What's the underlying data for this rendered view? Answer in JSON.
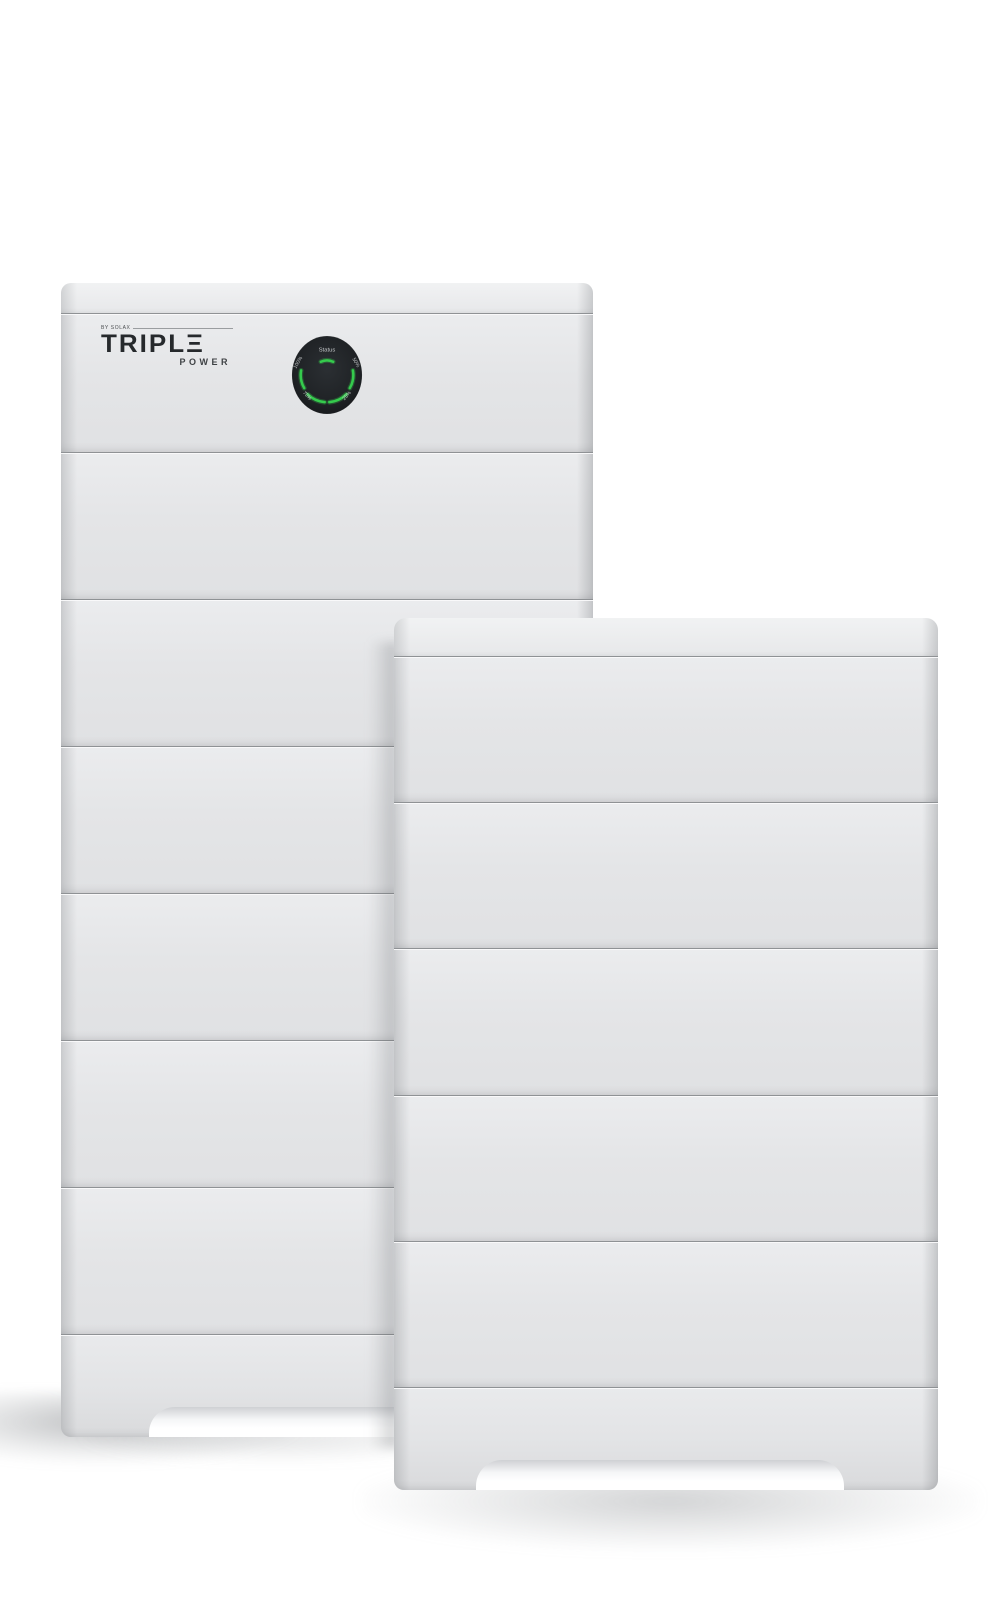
{
  "scene": {
    "type": "product-photo",
    "subject": "Two stacked modular battery storage towers on white background",
    "background_color": "#ffffff"
  },
  "branding": {
    "pretext": "BY SOLAX",
    "name": "TRIPLΞ",
    "subtext": "POWER"
  },
  "dial": {
    "status": "Status",
    "soc_upper_left": "100%",
    "soc_upper_right": "50%",
    "soc_lower_left": "75%",
    "soc_lower_right": "25%"
  },
  "left_tower": {
    "stacked_battery_modules": 6,
    "has_display_unit": true
  },
  "right_tower": {
    "stacked_battery_modules": 5,
    "has_display_unit": false
  },
  "colors": {
    "panel": "#e4e5e7",
    "panel_highlight": "#eff0f2",
    "seam": "#8f9295",
    "dial_background": "#1f2225",
    "led_green": "#35cb4d",
    "logo_dark": "#26292c"
  }
}
